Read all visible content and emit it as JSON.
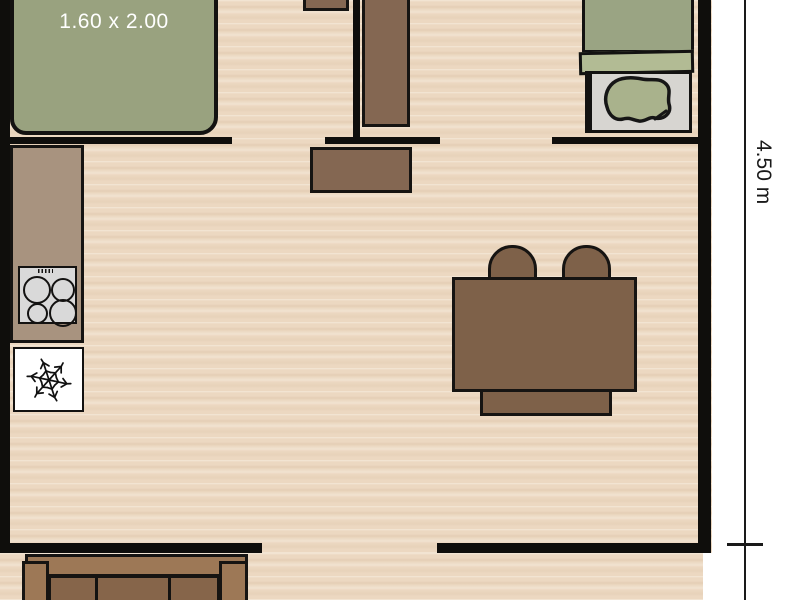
{
  "plan": {
    "type": "mobile-home-floor-plan",
    "labels": {
      "bed_size": "1.60 x 2.00",
      "side_dimension": "4.50 m"
    },
    "icons": {
      "fridge": "snowflake-icon",
      "hob": "four-burner-hob"
    },
    "colors": {
      "floor": "#ecd8c1",
      "wall": "#0f0e0c",
      "bed_green": "#99a27f",
      "mattress_green": "#9aa483",
      "blanket_green": "#b2bb94",
      "pillow_green": "#a9b28c",
      "sheet_gray": "#d7d5d1",
      "counter_taupe": "#a8937f",
      "hob_gray": "#d9d9d9",
      "fridge_white": "#ffffff",
      "wardrobe_wood": "#846752",
      "table_wood": "#7e6149",
      "sofa_wood": "#9d7856",
      "sofa_cushion": "#86654a",
      "outside": "#ffffff"
    },
    "furniture": [
      "double-bed",
      "bedside-table",
      "wardrobe",
      "dresser",
      "kitchen-counter",
      "hob",
      "fridge",
      "dining-table",
      "chair",
      "chair",
      "bench",
      "single-bed",
      "terrace-sofa"
    ]
  }
}
